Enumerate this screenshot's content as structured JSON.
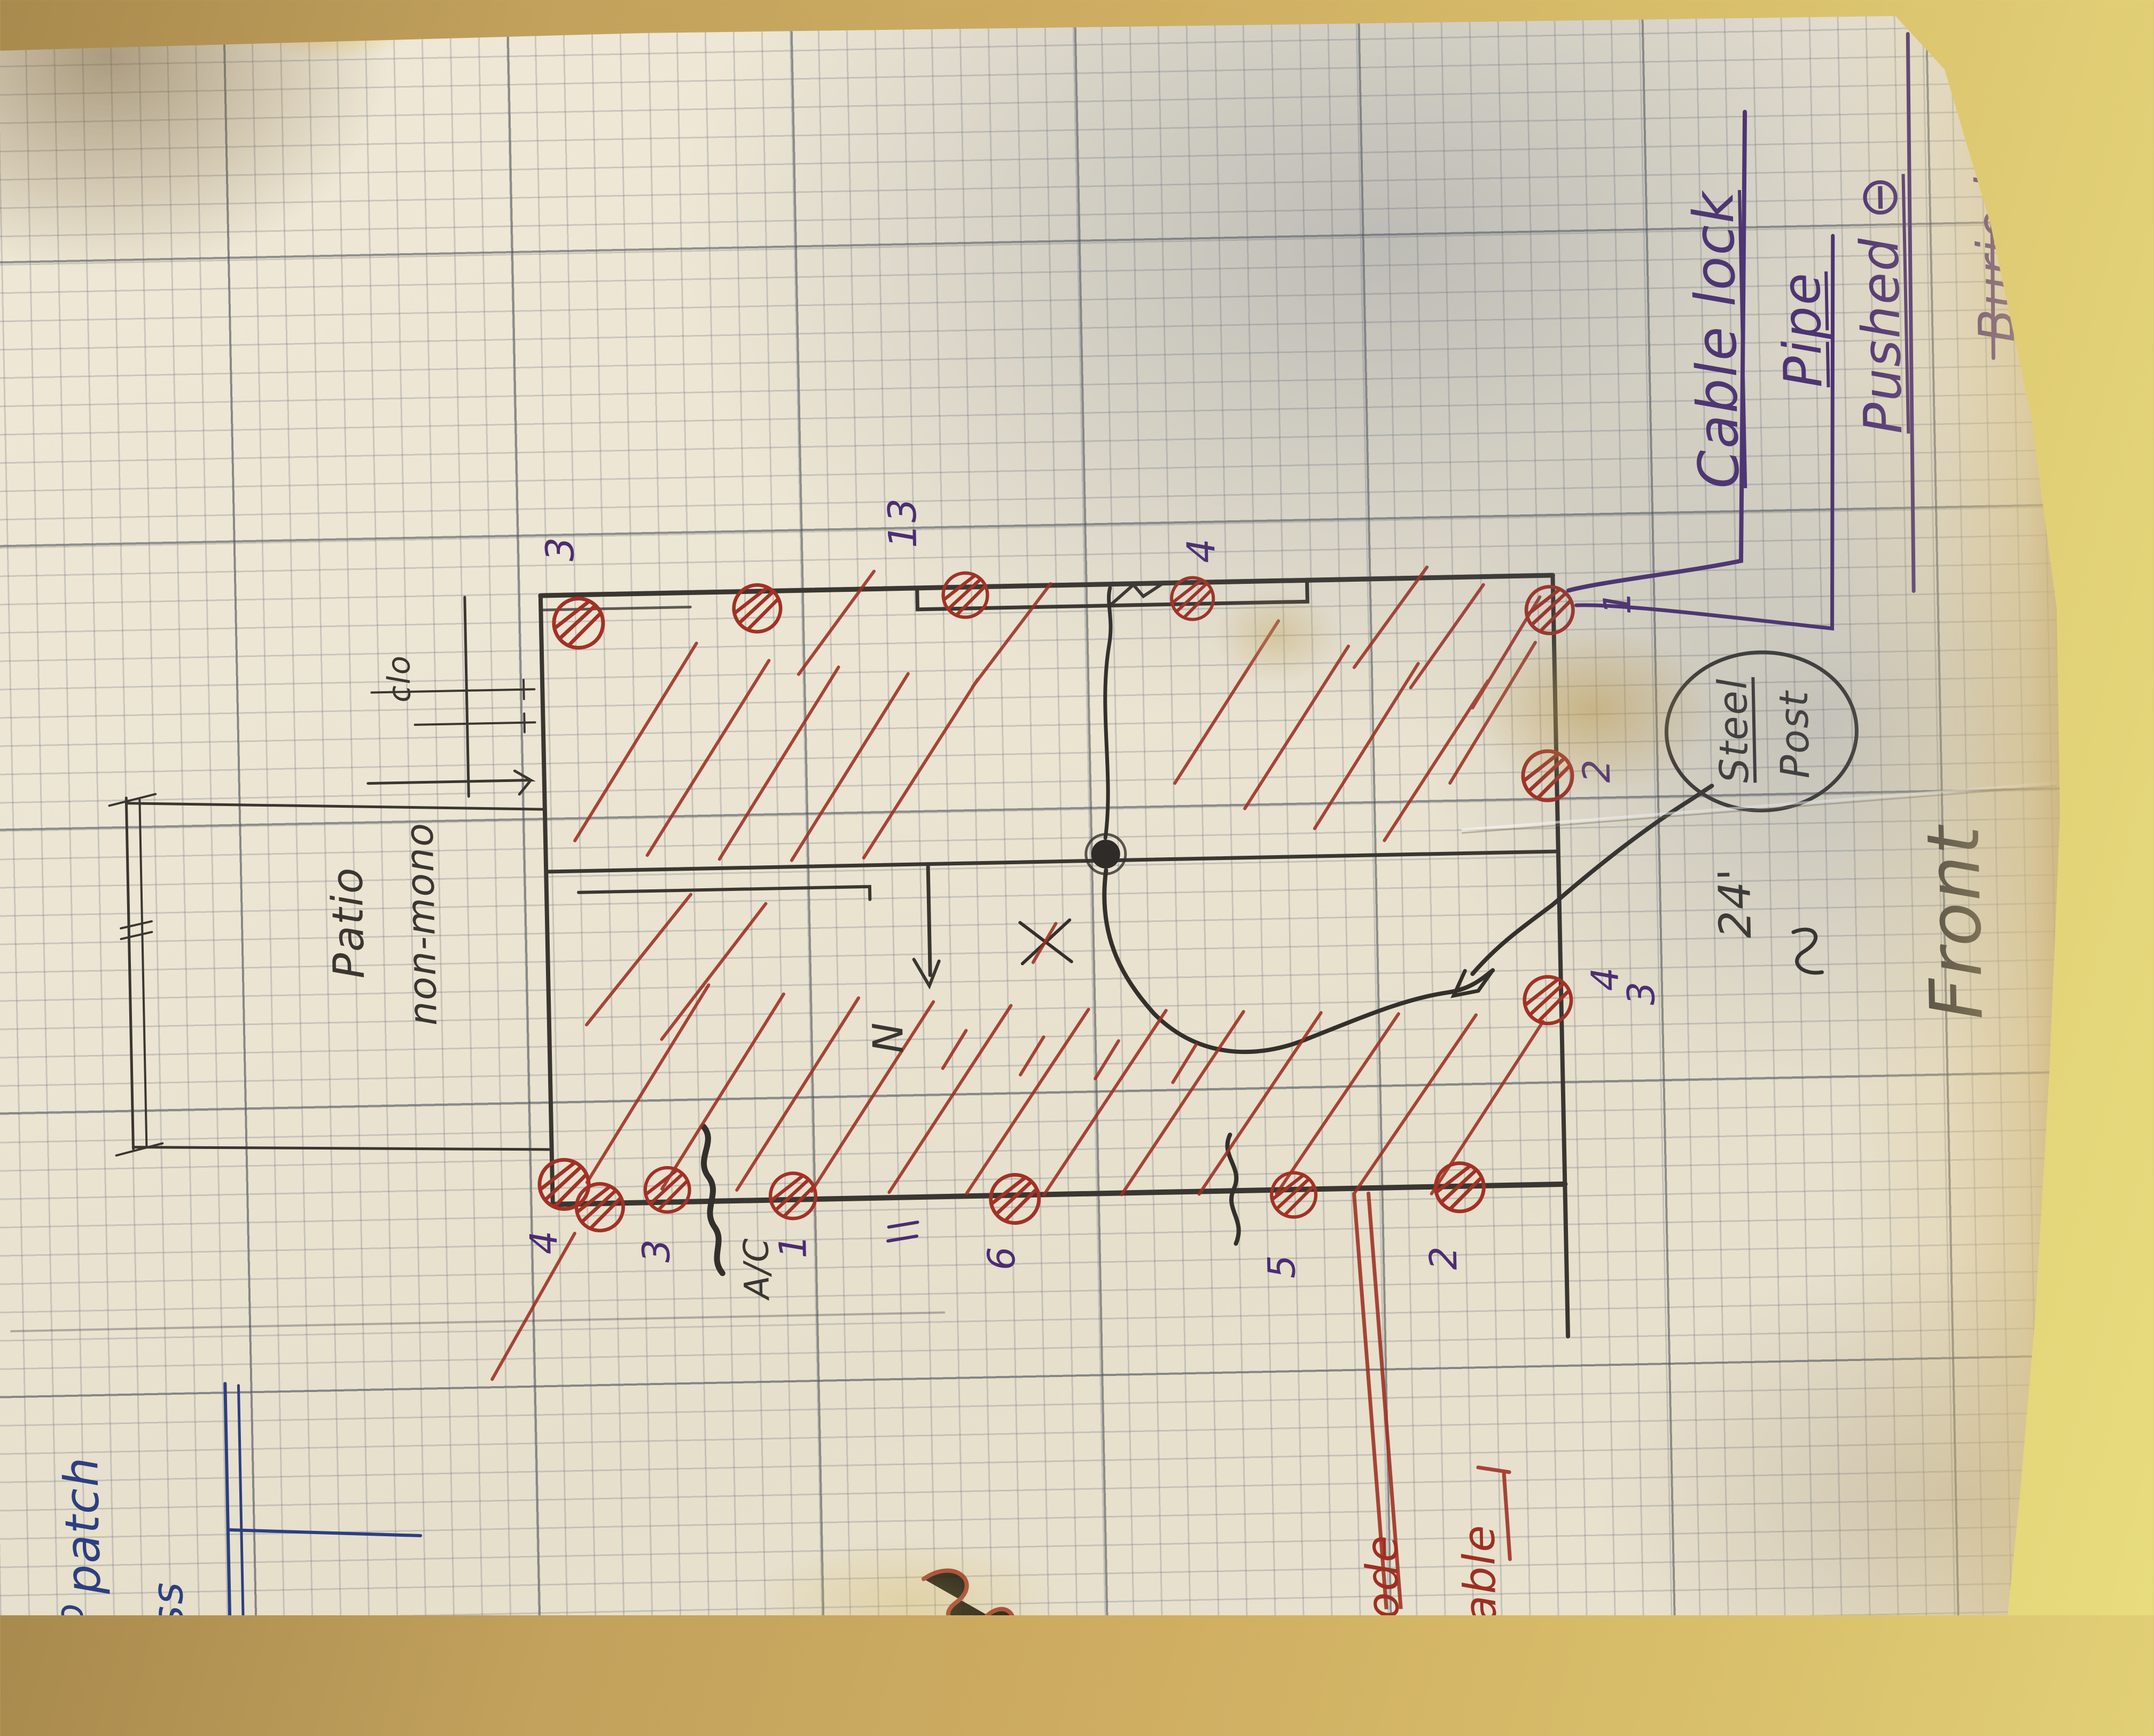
{
  "scene": "Photograph of a hand-drawn foundation pier plan on cream graph paper lying on a tan table; all handwriting is rotated 90 degrees (sheet drawn in landscape of the other orientation)",
  "colors": {
    "red_ink": "#9e2f22",
    "purple_ink": "#4b2c72",
    "blue_ink": "#2c3f80",
    "pencil": "#3a3631",
    "paper": "#ece5d3",
    "table": "#c9a75c"
  },
  "notes": {
    "cable": {
      "l1": "Cable lock",
      "l2": "Pipe",
      "l3": "Pushed ⊖",
      "l4": "Buried"
    },
    "steel_post": {
      "l1": "Steel",
      "l2": "Post"
    },
    "front": "Front",
    "dim24": "24'",
    "patio_l1": "Patio",
    "patio_l2": "non-mono",
    "clo": "clo",
    "ac": "A/C",
    "north": "N",
    "blue_patch": "patch",
    "blue_to": "to",
    "blue_frag": "oss",
    "red_frag1": "node",
    "red_frag2": "able"
  },
  "pier_labels": {
    "top": [
      "3",
      "13",
      "4"
    ],
    "right": [
      "1",
      "2",
      "4",
      "3"
    ],
    "bottom": [
      "4",
      "3",
      "1",
      "6",
      "5",
      "2"
    ]
  }
}
